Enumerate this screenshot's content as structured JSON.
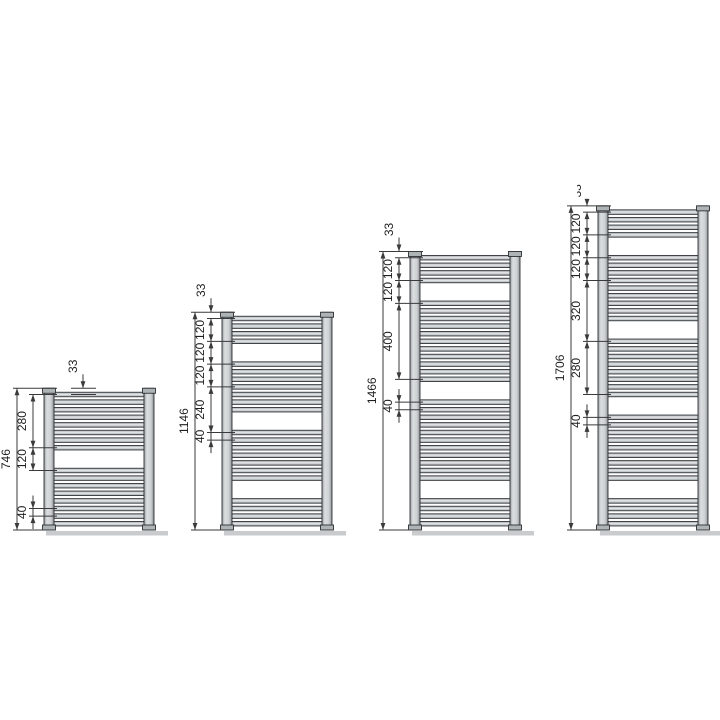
{
  "canvas": {
    "width": 720,
    "height": 720,
    "background": "#ffffff"
  },
  "colors": {
    "dim_line": "#3a3a3a",
    "dim_text": "#1f1f1f",
    "tube_stroke": "#2c3034",
    "rail_stroke": "#2c3034",
    "tube_fill_light": "#e7e9ea",
    "tube_fill_dark": "#84898d",
    "rail_fill": "#ccd0d2",
    "cap_fill": "#aeb3b6",
    "shadow": "#c9cbcc"
  },
  "tube_pitch_mm": 40,
  "radiators": [
    {
      "id": "radiator-746",
      "overall_label": "746",
      "height_mm": 746,
      "top_dim": {
        "label": "33",
        "from_mm": 0,
        "to_mm": 33,
        "clipped": false
      },
      "chain": [
        {
          "label": "280",
          "from_mm": 33,
          "to_mm": 313
        },
        {
          "label": "120",
          "from_mm": 313,
          "to_mm": 433
        }
      ],
      "detail_dims": [
        {
          "label": "40",
          "from_mm": 633,
          "to_mm": 673,
          "style": "outside"
        }
      ],
      "tube_groups": [
        {
          "start_mm": 33,
          "count": 8
        },
        {
          "start_mm": 433,
          "count": 8
        }
      ]
    },
    {
      "id": "radiator-1146",
      "overall_label": "1146",
      "height_mm": 1146,
      "top_dim": {
        "label": "33",
        "from_mm": 0,
        "to_mm": 33,
        "clipped": false
      },
      "chain": [
        {
          "label": "120",
          "from_mm": 33,
          "to_mm": 153
        },
        {
          "label": "120",
          "from_mm": 153,
          "to_mm": 273
        },
        {
          "label": "120",
          "from_mm": 273,
          "to_mm": 393
        },
        {
          "label": "240",
          "from_mm": 393,
          "to_mm": 633
        }
      ],
      "detail_dims": [
        {
          "label": "40",
          "from_mm": 633,
          "to_mm": 673,
          "style": "outside"
        }
      ],
      "tube_groups": [
        {
          "start_mm": 33,
          "count": 4
        },
        {
          "start_mm": 273,
          "count": 7
        },
        {
          "start_mm": 633,
          "count": 7
        },
        {
          "start_mm": 993,
          "count": 4
        }
      ]
    },
    {
      "id": "radiator-1466",
      "overall_label": "1466",
      "height_mm": 1466,
      "top_dim": {
        "label": "33",
        "from_mm": 0,
        "to_mm": 33,
        "clipped": false
      },
      "chain": [
        {
          "label": "120",
          "from_mm": 33,
          "to_mm": 153
        },
        {
          "label": "120",
          "from_mm": 153,
          "to_mm": 273
        },
        {
          "label": "400",
          "from_mm": 273,
          "to_mm": 673
        }
      ],
      "detail_dims": [
        {
          "label": "40",
          "from_mm": 793,
          "to_mm": 833,
          "style": "outside"
        }
      ],
      "tube_groups": [
        {
          "start_mm": 33,
          "count": 4
        },
        {
          "start_mm": 273,
          "count": 11
        },
        {
          "start_mm": 793,
          "count": 11
        },
        {
          "start_mm": 1313,
          "count": 4
        }
      ]
    },
    {
      "id": "radiator-1706",
      "overall_label": "1706",
      "height_mm": 1706,
      "top_dim": {
        "label": "33",
        "from_mm": 0,
        "to_mm": 33,
        "clipped": true
      },
      "chain": [
        {
          "label": "120",
          "from_mm": 33,
          "to_mm": 153
        },
        {
          "label": "120",
          "from_mm": 153,
          "to_mm": 273
        },
        {
          "label": "120",
          "from_mm": 273,
          "to_mm": 393
        },
        {
          "label": "320",
          "from_mm": 393,
          "to_mm": 713
        }
      ],
      "detail_dims": [
        {
          "label": "280",
          "from_mm": 713,
          "to_mm": 993,
          "style": "inside"
        },
        {
          "label": "40",
          "from_mm": 1113,
          "to_mm": 1153,
          "style": "outside"
        }
      ],
      "tube_groups": [
        {
          "start_mm": 33,
          "count": 4
        },
        {
          "start_mm": 273,
          "count": 9
        },
        {
          "start_mm": 713,
          "count": 8
        },
        {
          "start_mm": 1113,
          "count": 9
        },
        {
          "start_mm": 1553,
          "count": 4
        }
      ]
    }
  ]
}
